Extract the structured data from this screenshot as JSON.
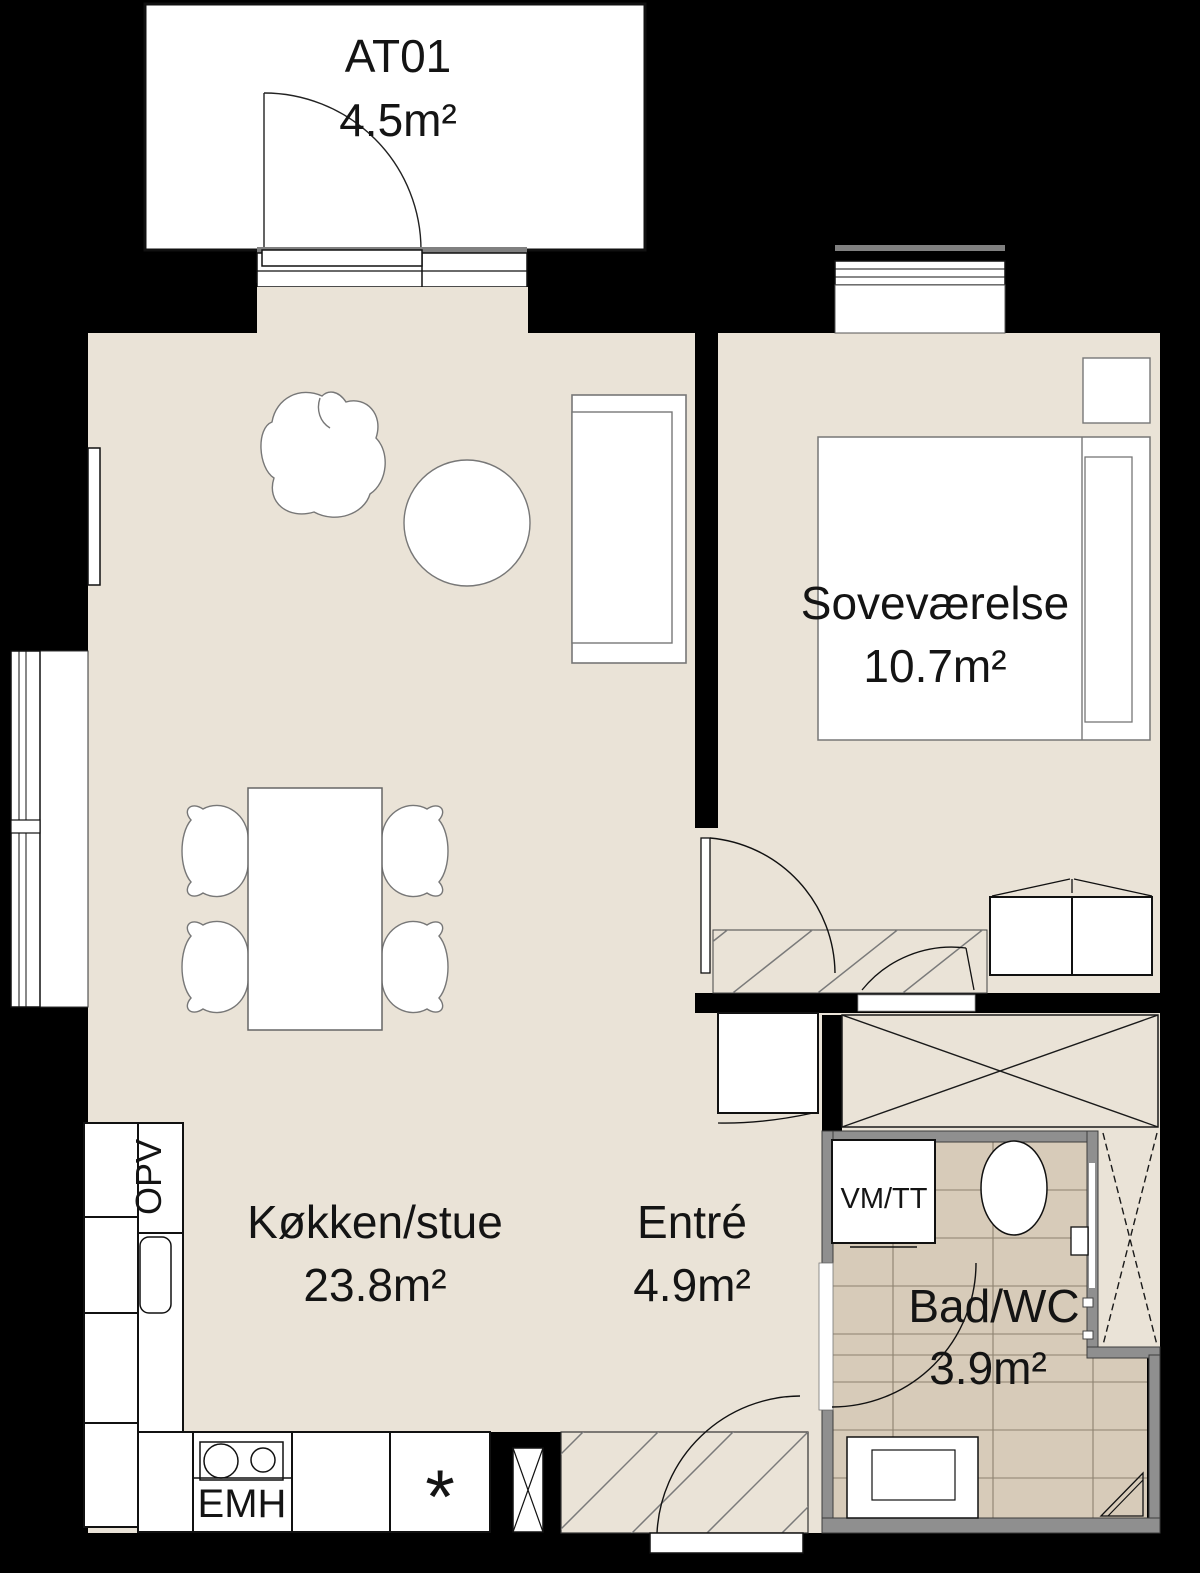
{
  "rooms": [
    {
      "name": "AT01",
      "area": "4.5m²"
    },
    {
      "name": "Soveværelse",
      "area": "10.7m²"
    },
    {
      "name": "Køkken/stue",
      "area": "23.8m²"
    },
    {
      "name": "Entré",
      "area": "4.9m²"
    },
    {
      "name": "Bad/WC",
      "area": "3.9m²"
    }
  ],
  "fixtures": {
    "dishwasher": "OPV",
    "washer_tumbler": "VM/TT",
    "extractor_hood": "EMH",
    "cabinet_note": "*"
  },
  "colors": {
    "background": "#000000",
    "floor": "#EAE3D7",
    "tile": "#D7CBB9",
    "grout": "#8C8170",
    "bathroom_wall": "#8F8F8F",
    "furniture": "#FFFFFF",
    "line": "#111111",
    "hatch": "#7A7A7A",
    "sill_gray": "#808080"
  }
}
